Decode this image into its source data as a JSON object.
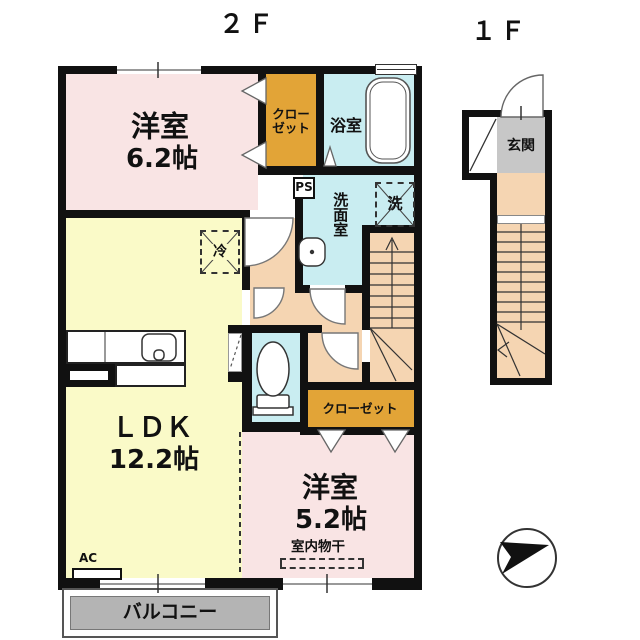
{
  "titles": {
    "second_floor": "２Ｆ",
    "first_floor": "１Ｆ"
  },
  "rooms": {
    "bedroom_a": {
      "name": "洋室",
      "size": "6.2帖"
    },
    "ldk": {
      "name": "ＬＤＫ",
      "size": "12.2帖"
    },
    "bedroom_b": {
      "name": "洋室",
      "size": "5.2帖"
    },
    "bath": {
      "name": "浴室"
    },
    "washroom": {
      "name": "洗面室"
    },
    "closet_top": {
      "line1": "クロー",
      "line2": "ゼット"
    },
    "closet_bottom": {
      "name": "クローゼット"
    },
    "balcony": {
      "name": "バルコニー"
    },
    "entrance": {
      "name": "玄関"
    }
  },
  "annotations": {
    "pipe_space": "PS",
    "washer": "洗",
    "fridge": "冷",
    "air_con": "AC",
    "indoor_drying": "室内物干"
  },
  "colors": {
    "wall": "#111111",
    "bedroom": "#f9e4e4",
    "ldk": "#fafac8",
    "wet": "#c9edf1",
    "closet": "#e2a437",
    "hall": "#f5d5b2",
    "balcony": "#b4b4b4",
    "entrance": "#c7c7c7"
  }
}
